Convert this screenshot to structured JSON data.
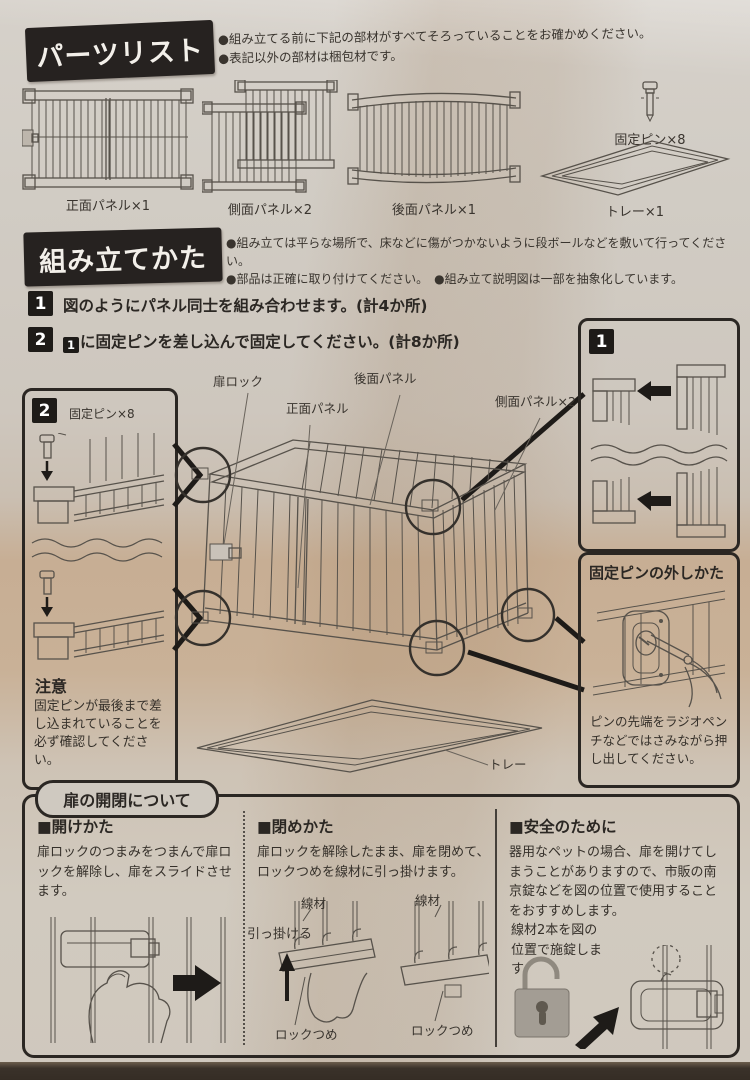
{
  "colors": {
    "banner_black": "#262220",
    "paper": "#cfc9c1",
    "padlock_gray": "#a39d94"
  },
  "parts_list": {
    "title": "パーツリスト",
    "note1": "●組み立てる前に下記の部材がすべてそろっていることをお確かめください。",
    "note2": "●表記以外の部材は梱包材です。",
    "items": [
      {
        "label": "正面パネル×1"
      },
      {
        "label": "側面パネル×2"
      },
      {
        "label": "後面パネル×1"
      },
      {
        "label": "トレー×1"
      },
      {
        "label": "固定ピン×8"
      }
    ]
  },
  "assembly": {
    "title": "組み立てかた",
    "note1": "●組み立ては平らな場所で、床などに傷がつかないように段ボールなどを敷いて行ってください。",
    "note2": "●部品は正確に取り付けてください。　●組み立て説明図は一部を抽象化しています。",
    "steps": [
      {
        "num": "1",
        "text": "図のようにパネル同士を組み合わせます。(計4か所)"
      },
      {
        "num": "2",
        "ref": "1",
        "text": "に固定ピンを差し込んで固定してください。(計8か所)"
      }
    ],
    "labels": {
      "door_lock": "扉ロック",
      "front_panel": "正面パネル",
      "back_panel": "後面パネル",
      "side_panel": "側面パネル×2",
      "tray": "トレー"
    },
    "box1": {
      "num": "1"
    },
    "box2": {
      "num": "2",
      "pin_label": "固定ピン×8",
      "caution_title": "注意",
      "caution_text": "固定ピンが最後まで差し込まれていることを必ず確認してください。"
    },
    "pin_removal": {
      "title": "固定ピンの外しかた",
      "text": "ピンの先端をラジオペンチなどではさみながら押し出してください。"
    }
  },
  "door_section": {
    "title": "扉の開閉について",
    "open": {
      "heading": "■開けかた",
      "text": "扉ロックのつまみをつまんで扉ロックを解除し、扉をスライドさせます。"
    },
    "close": {
      "heading": "■閉めかた",
      "text": "扉ロックを解除したまま、扉を閉めて、ロックつめを線材に引っ掛けます。",
      "wire": "線材",
      "hook": "引っ掛ける",
      "claw": "ロックつめ"
    },
    "safety": {
      "heading": "■安全のために",
      "text": "器用なペットの場合、扉を開けてしまうことがありますので、市販の南京錠などを図の位置で使用することをおすすめします。",
      "note": "線材2本を図の位置で施錠します。"
    }
  }
}
